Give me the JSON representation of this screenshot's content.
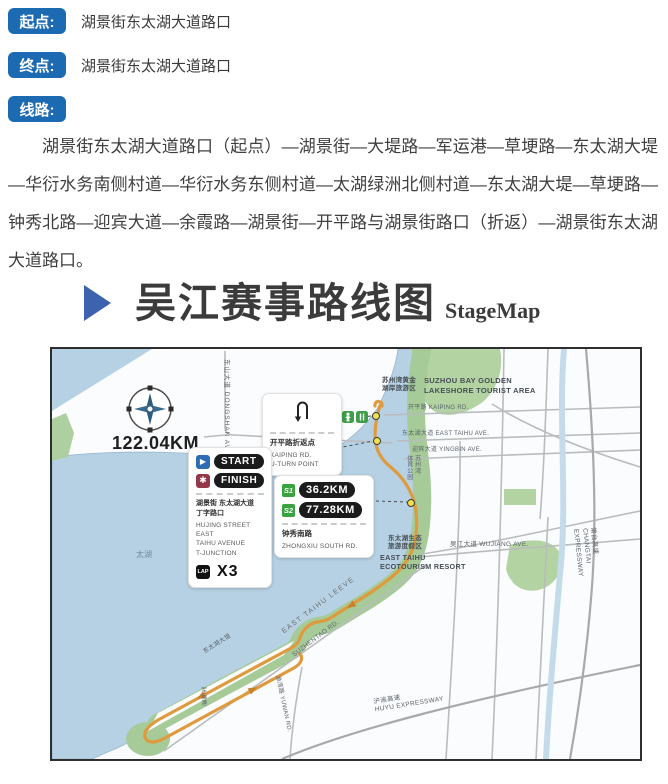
{
  "info_rows": [
    {
      "label": "起点:",
      "value": "湖景街东太湖大道路口"
    },
    {
      "label": "终点:",
      "value": "湖景街东太湖大道路口"
    },
    {
      "label": "线路:",
      "value": ""
    }
  ],
  "route_paragraph": "湖景街东太湖大道路口（起点）—湖景街—大堤路—军运港—草埂路—东太湖大堤—华衍水务南侧村道—华衍水务东侧村道—太湖绿洲北侧村道—东太湖大堤—草埂路—钟秀北路—迎宾大道—余霞路—湖景街—开平路与湖景街路口（折返）—湖景街东太湖大道路口。",
  "title": {
    "zh": "吴江赛事路线图",
    "en": "StageMap"
  },
  "map": {
    "distance": "122.04KM",
    "labels": {
      "dongshan": "东山大道 DONGSHAN AVE.",
      "kaiping_rd": "开平路 KAIPING RD.",
      "east_taihu_ave": "东太湖大道 EAST TAIHU AVE.",
      "yingbin_ave": "迎宾大道 YINGBIN AVE.",
      "wujiang_ave": "吴江大道 WUJIANG AVE.",
      "suzhou_bay_zh": "苏州湾黄金\n湖岸旅游区",
      "suzhou_bay_en": "SUZHOU BAY GOLDEN\nLAKESHORE TOURIST AREA",
      "resort_zh": "东太湖生态\n旅游度假区",
      "resort_en": "EAST TAIHU\nECOTOURISM RESORT",
      "taihu": "太湖",
      "leeve_en": "EAST TAIHU LEEVE",
      "leeve_zh": "东太湖大堤",
      "suzhentao_rd": "SUZHENTAO RD.",
      "yuwan_rd": "渔湾路 YUWAN RD.",
      "junyungang": "军运港",
      "sports_park": "苏州湾\n体育公园",
      "changtai": "常台高速 CHANGTAI EXPRESSWAY",
      "huyu": "沪渝高速\nHUYU EXPRESSWAY"
    },
    "callouts": {
      "uturn": {
        "zh": "开平路折返点",
        "en": "KAIPING RD.\nU-TURN POINT"
      },
      "start_finish": {
        "start": "START",
        "finish": "FINISH",
        "zh": "湖景街 东太湖大道\n丁字路口",
        "en": "HUJING STREET EAST\nTAIHU AVENUE\nT-JUNCTION",
        "lap": "LAP",
        "laps": "X3"
      },
      "stations": {
        "s1": "S1",
        "s1_km": "36.2KM",
        "s2": "S2",
        "s2_km": "77.28KM",
        "zh": "钟秀南路",
        "en": "ZHONGXIU SOUTH RD."
      }
    },
    "colors": {
      "badge_blue": "#1c6ab2",
      "water": "#b6d1e4",
      "green": "#a6cb99",
      "route_orange": "#df9a3e",
      "start_blue": "#2f6cb4",
      "finish_red": "#933849",
      "station_green": "#38a33e"
    }
  }
}
